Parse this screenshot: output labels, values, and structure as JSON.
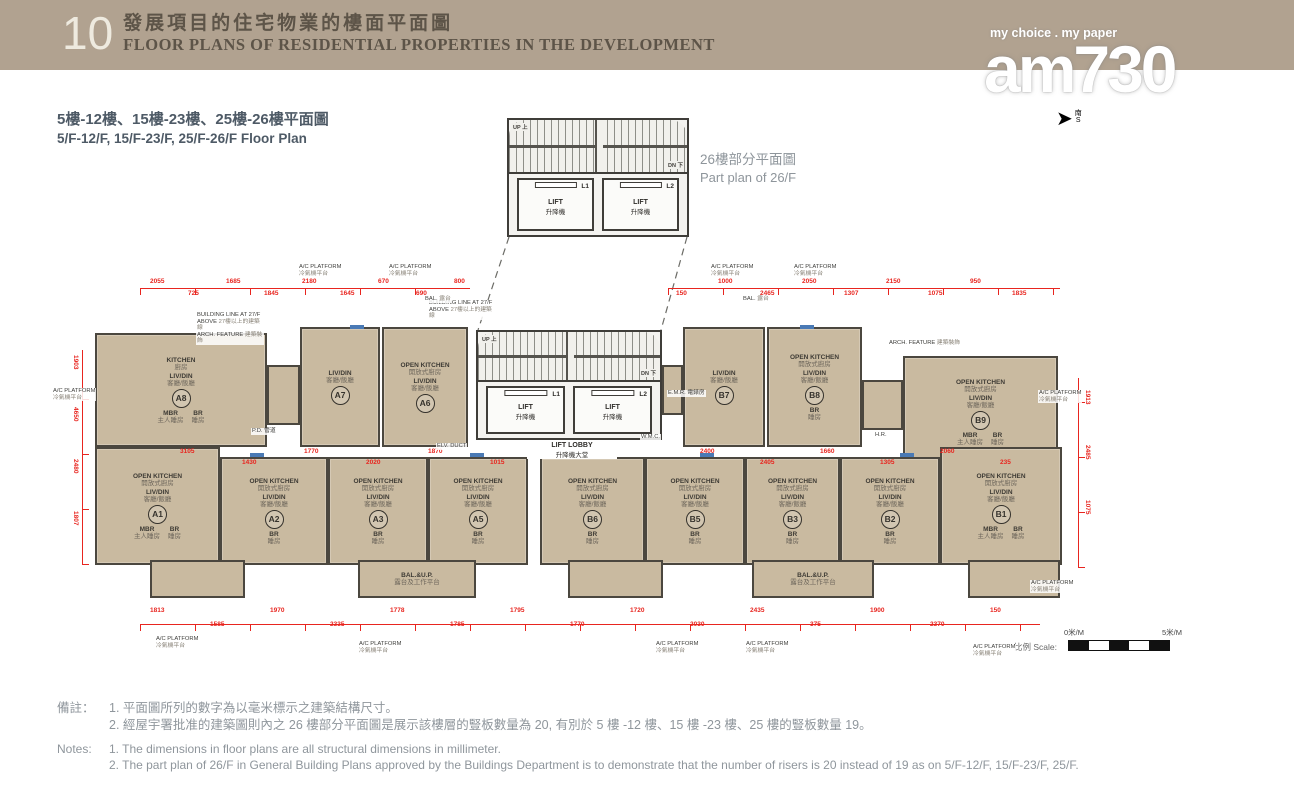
{
  "header": {
    "page_no": "10",
    "title_zh": "發展項目的住宅物業的樓面平面圖",
    "title_en": "FLOOR PLANS OF RESIDENTIAL PROPERTIES IN THE DEVELOPMENT"
  },
  "logo": {
    "tagline": "my choice . my paper",
    "name": "am730",
    "compass_zh": "南",
    "compass_en": "S"
  },
  "subtitle": {
    "zh": "5樓-12樓、15樓-23樓、25樓-26樓平面圖",
    "en": "5/F-12/F, 15/F-23/F, 25/F-26/F Floor Plan"
  },
  "part_plan": {
    "label_zh": "26樓部分平面圖",
    "label_en": "Part plan of 26/F"
  },
  "core": {
    "lift_en": "LIFT",
    "lift_zh": "升降機",
    "l1": "L1",
    "l2": "L2",
    "lobby_en": "LIFT LOBBY",
    "lobby_zh": "升降機大堂",
    "up": "UP 上",
    "dn": "DN 下",
    "emr": "E.M.R. 電錶房",
    "wmc": "W.M.C.",
    "pd": "P.D. 管道",
    "hr": "H.R.",
    "elv": "ELV. DUCT"
  },
  "rooms": {
    "livdin_en": "LIV/DIN",
    "livdin_zh": "客廳/飯廳",
    "br_en": "BR",
    "br_zh": "睡房",
    "mbr_en": "MBR",
    "mbr_zh": "主人睡房",
    "okitchen_en": "OPEN KITCHEN",
    "okitchen_zh": "開放式廚房",
    "kitchen_en": "KITCHEN",
    "kitchen_zh": "廚房",
    "bal_en": "BAL.",
    "bal_zh": "露台",
    "balup_en": "BAL.&U.P.",
    "balup_zh": "露台及工作平台",
    "acplat_en": "A/C PLATFORM",
    "acplat_zh": "冷氣機平台"
  },
  "annotations": {
    "building_line_en": "BUILDING LINE AT 27/F ABOVE",
    "building_line_zh": "27樓以上的建築線",
    "arch_feature_en": "ARCH. FEATURE",
    "arch_feature_zh": "建築裝飾"
  },
  "units": {
    "upper": [
      "A8",
      "A7",
      "A6",
      "B7",
      "B8",
      "B9"
    ],
    "lower": [
      "A1",
      "A2",
      "A3",
      "A5",
      "B6",
      "B5",
      "B3",
      "B2",
      "B1"
    ]
  },
  "dimensions": [
    "2055",
    "725",
    "1685",
    "1845",
    "2180",
    "1645",
    "670",
    "690",
    "800",
    "150",
    "1000",
    "2465",
    "2050",
    "1307",
    "2150",
    "1075",
    "950",
    "1835",
    "3105",
    "1430",
    "1770",
    "2020",
    "1870",
    "1015",
    "2400",
    "2405",
    "1660",
    "1305",
    "2060",
    "235",
    "1813",
    "1585",
    "1970",
    "2335",
    "1778",
    "1785",
    "1795",
    "1770",
    "1720",
    "2030",
    "2435",
    "375",
    "1900",
    "2370",
    "150",
    "1903",
    "4650",
    "2480",
    "1807",
    "1913",
    "2485",
    "1075"
  ],
  "scale": {
    "label_zh": "比例",
    "label_en": "Scale:",
    "start": "0米/M",
    "end": "5米/M"
  },
  "notes": {
    "label_zh": "備註：",
    "label_en": "Notes:",
    "zh": [
      "1. 平面圖所列的數字為以毫米標示之建築結構尺寸。",
      "2. 經屋宇署批准的建築圖則內之 26 樓部分平面圖是展示該樓層的豎板數量為 20, 有別於 5 樓 -12 樓、15 樓 -23 樓、25 樓的豎板數量 19。"
    ],
    "en": [
      "1. The dimensions in floor plans are all structural dimensions in millimeter.",
      "2. The part plan of 26/F in General Building Plans approved by the Buildings Department is to demonstrate that the number of risers is 20 instead of 19 as on 5/F-12/F, 15/F-23/F, 25/F."
    ]
  }
}
